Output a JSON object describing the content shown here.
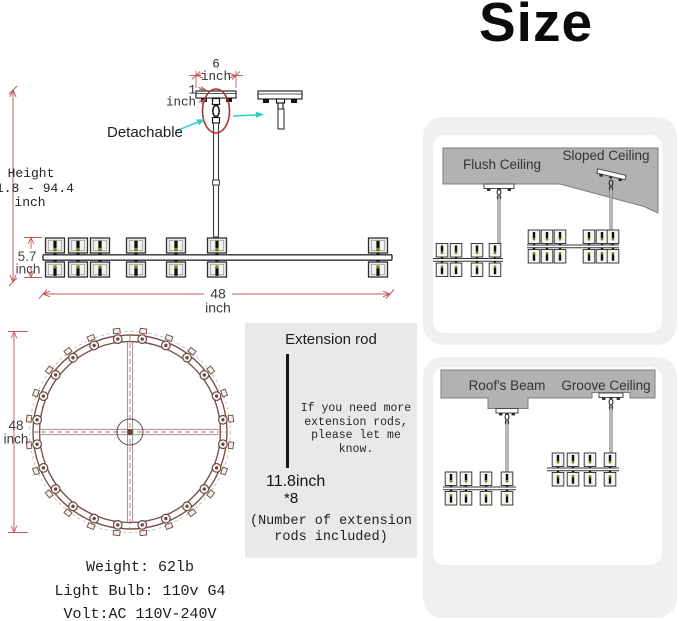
{
  "title": "Size",
  "front_view": {
    "detachable": "Detachable",
    "dim6_value": "6",
    "dim6_unit": "inch",
    "dim1_value": "1",
    "dim1_unit": "inch",
    "height_label": "Height",
    "height_range": "11.8 - 94.4",
    "height_unit": "inch",
    "dim57_value": "5.7",
    "dim57_unit": "inch",
    "dim48_value": "48",
    "dim48_unit": "inch"
  },
  "top_view": {
    "dim_value": "48",
    "dim_unit": "inch",
    "bulb_count": 24
  },
  "extension_box": {
    "title": "Extension rod",
    "note": "If you need more\nextension rods,\nplease let me know.",
    "rod_length": "11.8inch",
    "rod_qty": "*8",
    "caption": "(Number of extension\nrods included)"
  },
  "specs": {
    "weight": "Weight: 62lb",
    "bulb": "Light Bulb: 110v G4",
    "volt": "Volt:AC 110V-240V"
  },
  "panels": [
    {
      "labels": [
        "Flush Ceiling",
        "Sloped Ceiling"
      ]
    },
    {
      "labels": [
        "Roof's Beam",
        "Groove Ceiling"
      ]
    }
  ],
  "colors": {
    "dimension_red": "#c05b58",
    "highlight_red": "#a93434",
    "arrow_cyan": "#2dd0c5",
    "ceiling_gray": "#b2b2b2",
    "panel_gray": "#f0f0f0",
    "ring_brown": "#7d524c"
  }
}
